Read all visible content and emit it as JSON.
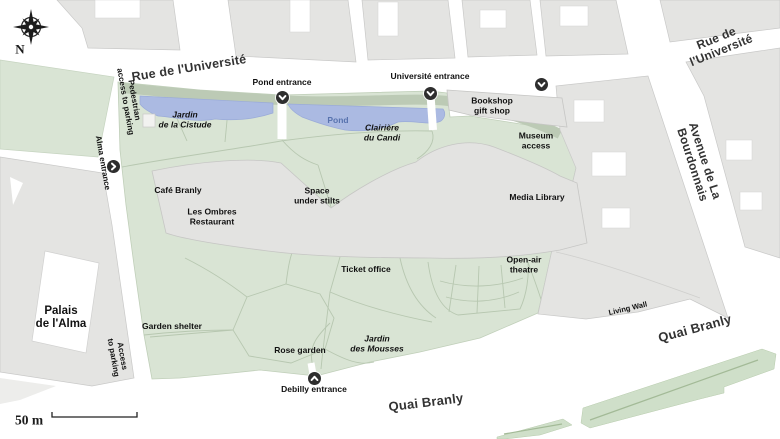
{
  "map": {
    "compass": {
      "north_label": "N"
    },
    "scale_bar": {
      "label": "50 m"
    },
    "streets": {
      "rue_universite_main": "Rue de l'Université",
      "rue_universite_ne": "Rue de l'Université",
      "avenue_bourdonnais": "Avenue de La Bourdonnais",
      "quai_branly_south": "Quai Branly",
      "quai_branly_east": "Quai Branly"
    },
    "entrances": {
      "pond": {
        "label": "Pond entrance",
        "direction": "down"
      },
      "universite": {
        "label": "Université entrance",
        "direction": "down"
      },
      "bookshop_side": {
        "label": "",
        "direction": "down"
      },
      "alma": {
        "label": "Alma entrance",
        "direction": "right"
      },
      "debilly": {
        "label": "Debilly entrance",
        "direction": "up"
      }
    },
    "access": {
      "pedestrian_parking": "Pedestrian\naccess to parking",
      "south_parking": "Access\nto parking"
    },
    "buildings": {
      "palais_alma": "Palais\nde l'Alma",
      "bookshop": "Bookshop\ngift shop",
      "museum_access": "Museum\naccess",
      "media_library": "Media Library",
      "cafe_branly": "Café Branly",
      "les_ombres": "Les Ombres\nRestaurant"
    },
    "garden": {
      "jardin_cistude": "Jardin\nde la Cistude",
      "pond": "Pond",
      "clairiere_candi": "Clairière\ndu Candi",
      "space_under_stilts": "Space\nunder stilts",
      "ticket_office": "Ticket office",
      "open_air_theatre": "Open-air\ntheatre",
      "rose_garden": "Rose garden",
      "garden_shelter": "Garden shelter",
      "jardin_mousses": "Jardin\ndes Mousses",
      "living_wall": "Living Wall"
    },
    "colors": {
      "garden_green": "#d9e4d4",
      "hedge_green": "#bccab5",
      "water_blue": "#abbae2",
      "water_label": "#5873ae",
      "block_gray": "#e4e4e2",
      "road_white": "#ffffff",
      "marker_dark": "#2e2e2e",
      "path_green": "#b7c7b0",
      "strip_green": "#cfdfc9",
      "label_text": "#111111"
    }
  }
}
